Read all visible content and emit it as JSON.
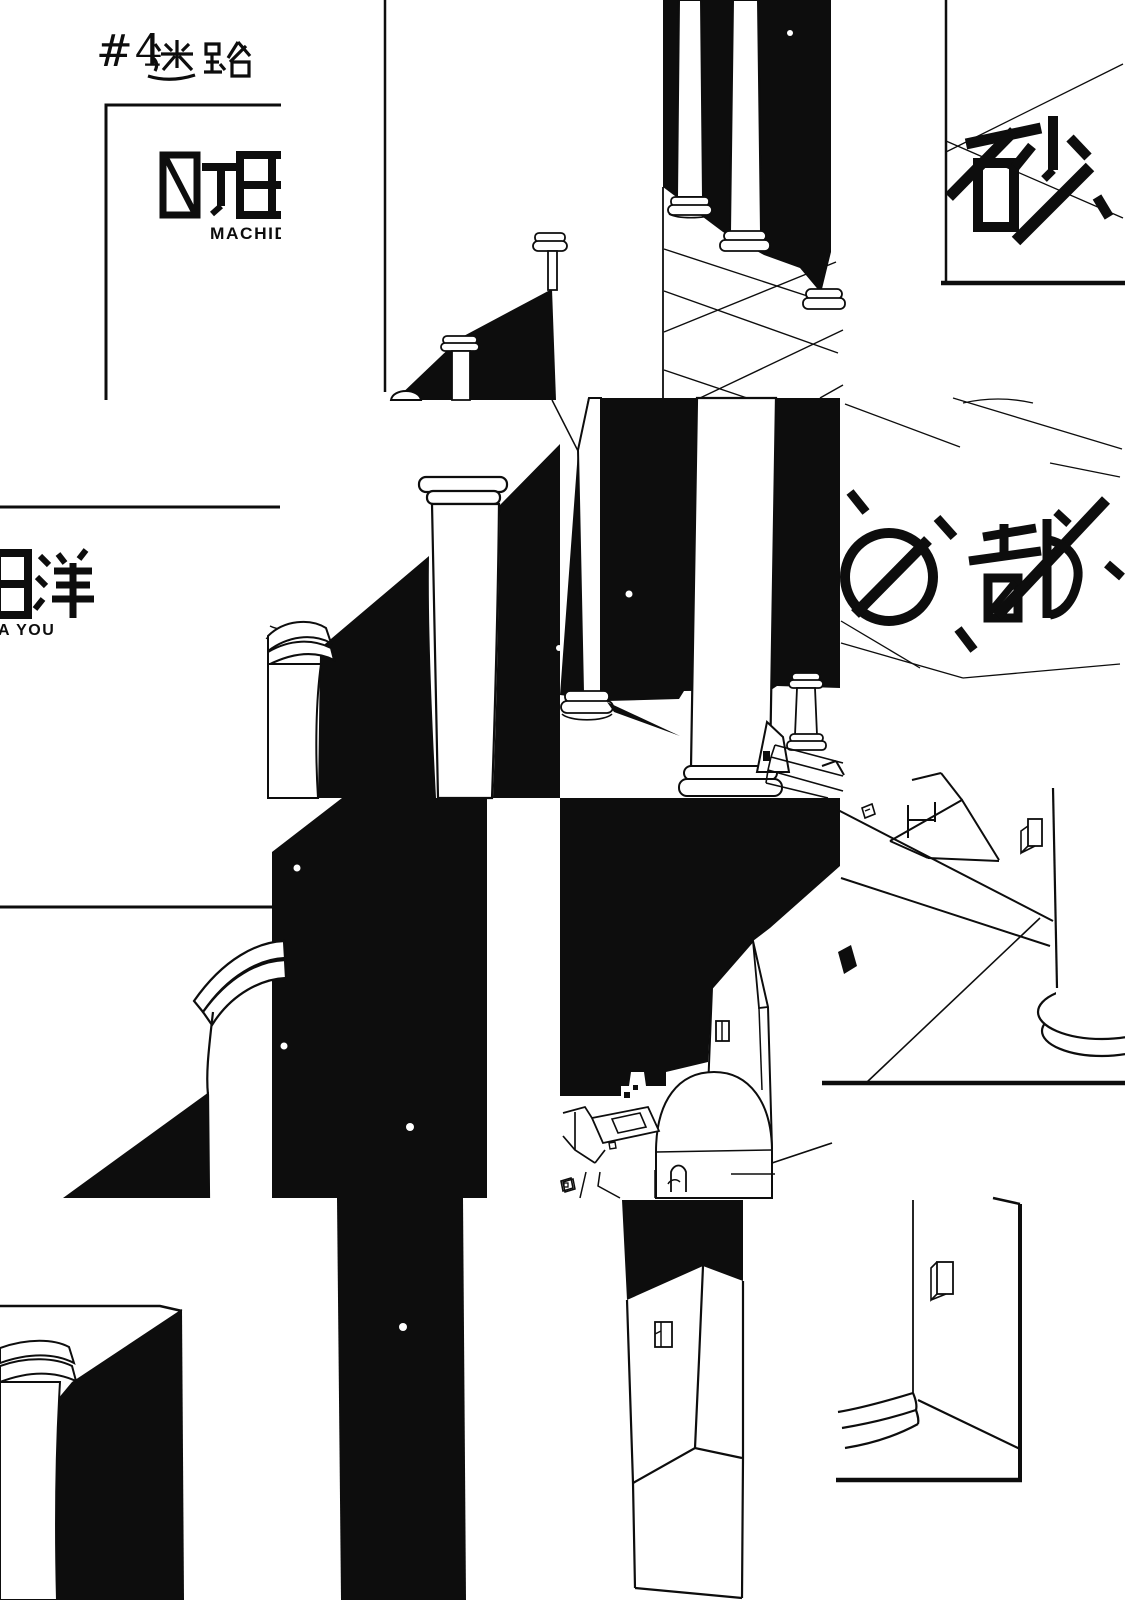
{
  "colors": {
    "ink": "#0d0d0d",
    "paper": "#ffffff"
  },
  "chapter_heading": {
    "number": "#4",
    "title_kanji": "迷路"
  },
  "title_page": {
    "author_kanji": "町田",
    "author_romaji": "MACHIDA"
  },
  "title_page_offset": {
    "author_kanji_fragment": "田洋",
    "author_romaji_fragment": "A YOU"
  },
  "series_logo": {
    "fragment_right_top": "砂",
    "fragment_right_middle": "の都"
  }
}
